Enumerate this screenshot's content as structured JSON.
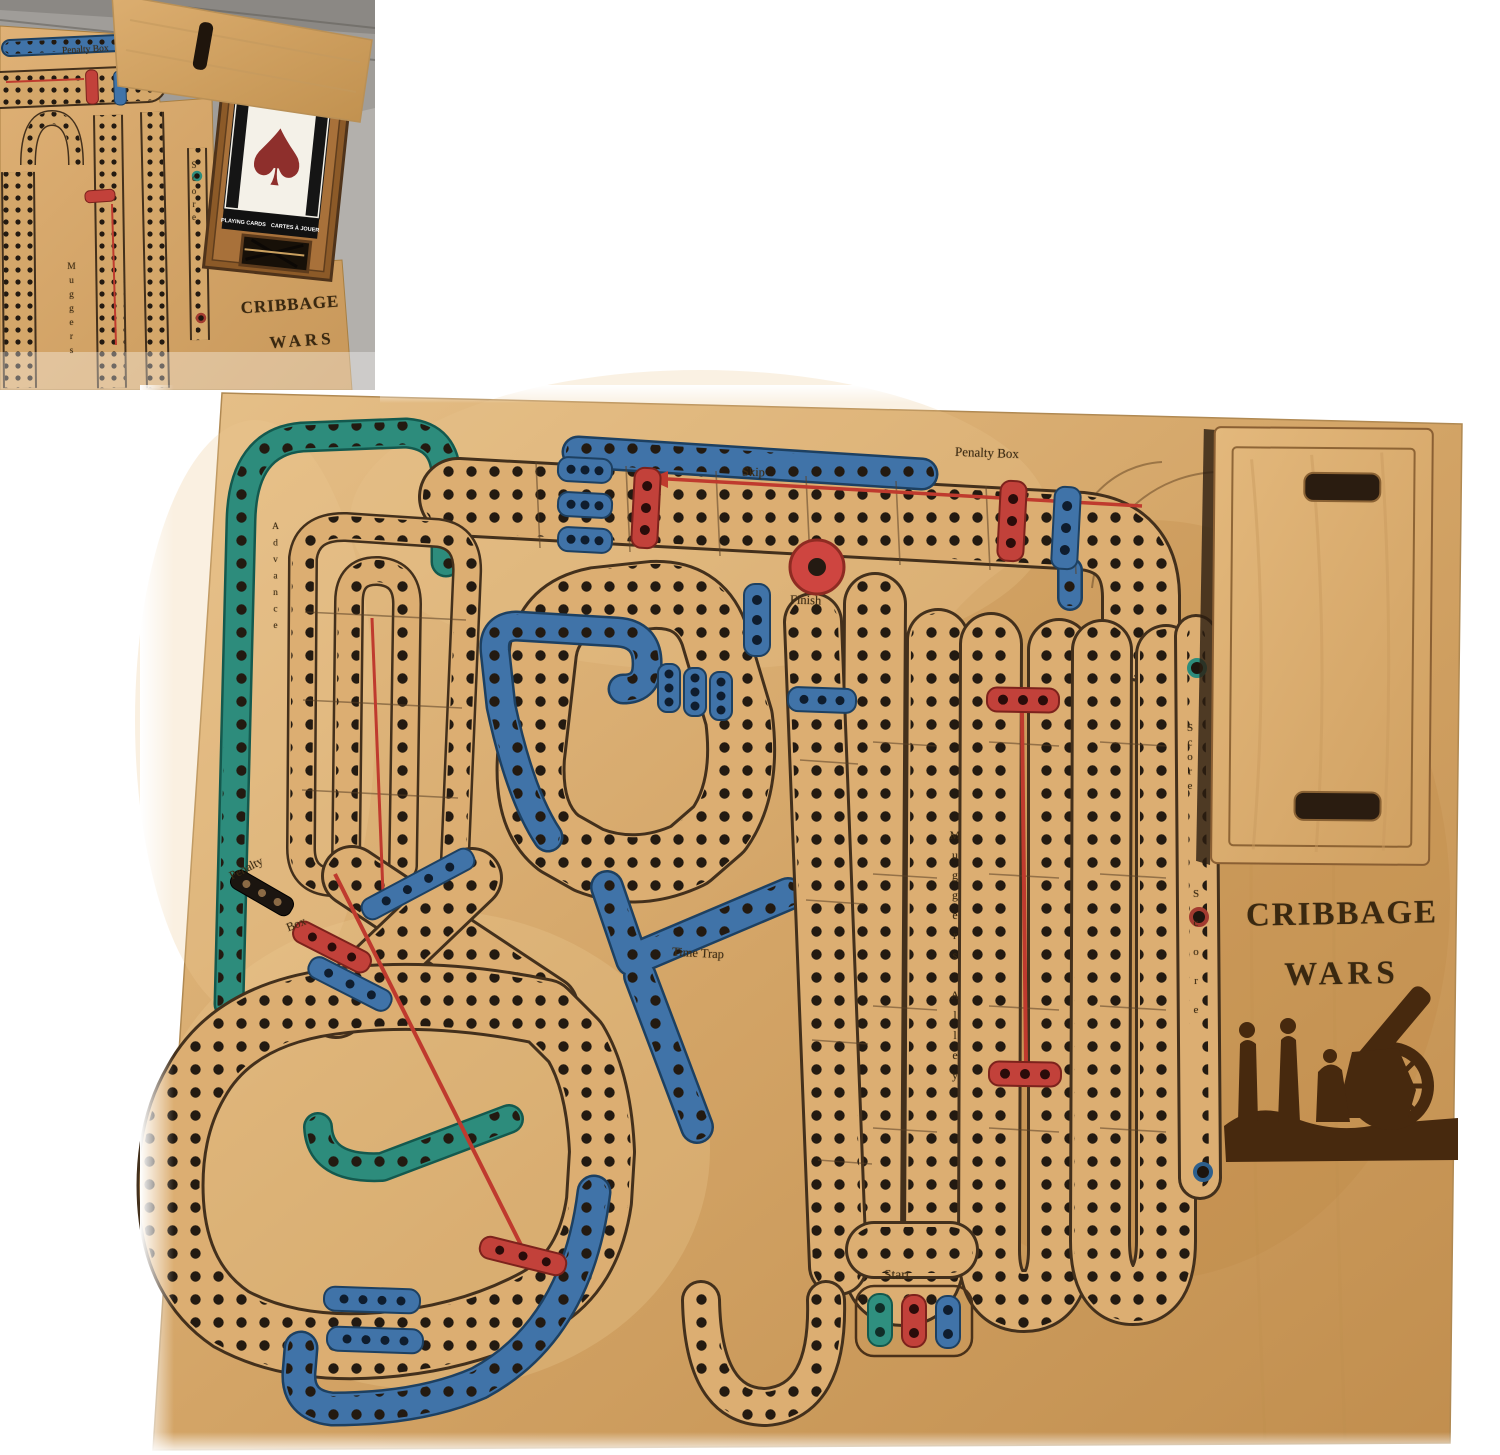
{
  "inset": {
    "labels": {
      "penalty_box": "Penalty Box",
      "score": "Score",
      "muggers": "Muggers",
      "title_line1": "CRIBBAGE",
      "title_line2": "WARS",
      "card_left": "PLAYING CARDS",
      "card_right": "CARTES À JOUER"
    }
  },
  "board": {
    "labels": {
      "penalty_box_top": "Penalty Box",
      "skip": "Skip",
      "finish": "Finish",
      "time_trap": "Time Trap",
      "start": "Start",
      "muggers_alley": "Muggers Alley",
      "advance": "Advance",
      "score_upper": "Score",
      "score_lower": "Score",
      "penalty_left_1": "Penalty",
      "penalty_left_2": "Box",
      "title_line1": "CRIBBAGE",
      "title_line2": "WARS"
    }
  },
  "colors": {
    "wood_light": "#e6c089",
    "wood_mid": "#d3a466",
    "wood_dark": "#c18e4e",
    "track_bed": "#dcae72",
    "teal_track": "#2d8c7c",
    "blue_track": "#4073a8",
    "red_marker": "#c2413a",
    "peg_hole": "#231a11",
    "engraving": "#3c2b13",
    "silhouette": "#47290e",
    "card_box_wood": "#8c5a28",
    "card_face": "#f4f1e8",
    "card_spade": "#8e2f2c",
    "floor_gray": "#a09d99"
  }
}
